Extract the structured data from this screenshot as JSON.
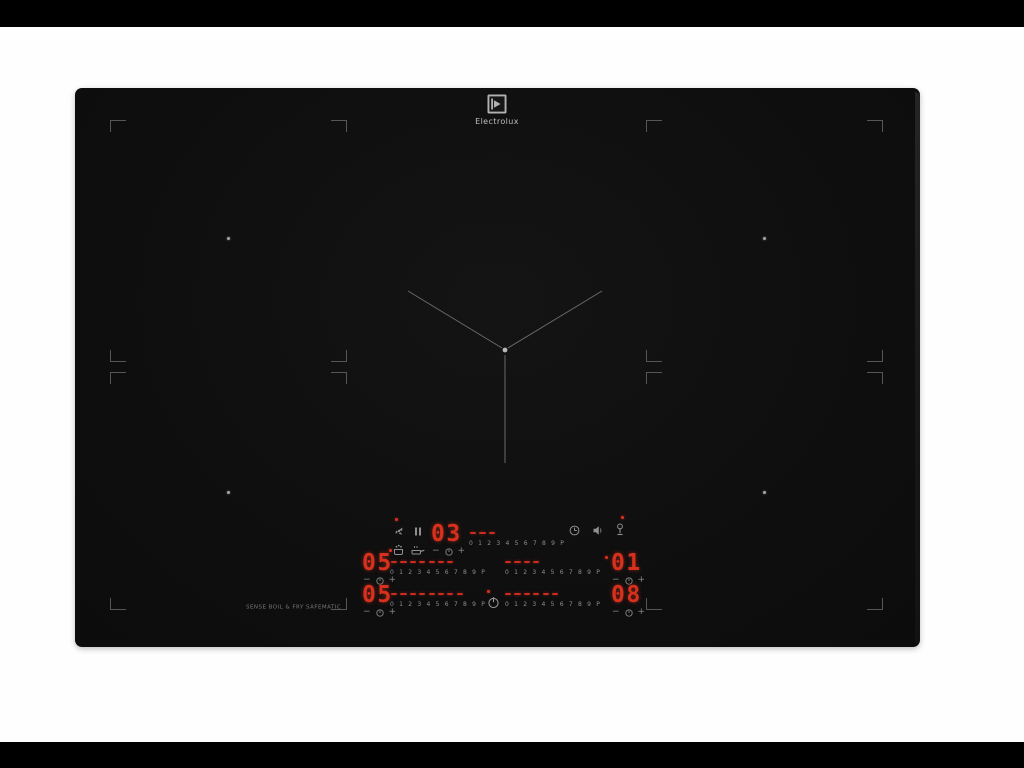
{
  "page": {
    "background": "#fefefe",
    "letterbox_color": "#000000"
  },
  "brand": {
    "name": "Electrolux"
  },
  "hob": {
    "body_color": "#101010",
    "print_label": "SENSE BOIL & FRY SAFEMATIC"
  },
  "controls": {
    "accent_red": "#cf2b1c",
    "scale_ticks": [
      "0",
      "1",
      "2",
      "3",
      "4",
      "5",
      "6",
      "7",
      "8",
      "9",
      "P"
    ],
    "displays": {
      "timer": "03",
      "middle_left": "05",
      "middle_right": "01",
      "bottom_left": "05",
      "bottom_right": "08"
    },
    "slider_levels": {
      "timer": 3,
      "middle_left": 7,
      "middle_right": 4,
      "bottom_left": 8,
      "bottom_right": 6
    },
    "glyphs": {
      "minus": "−",
      "plus": "+"
    }
  }
}
